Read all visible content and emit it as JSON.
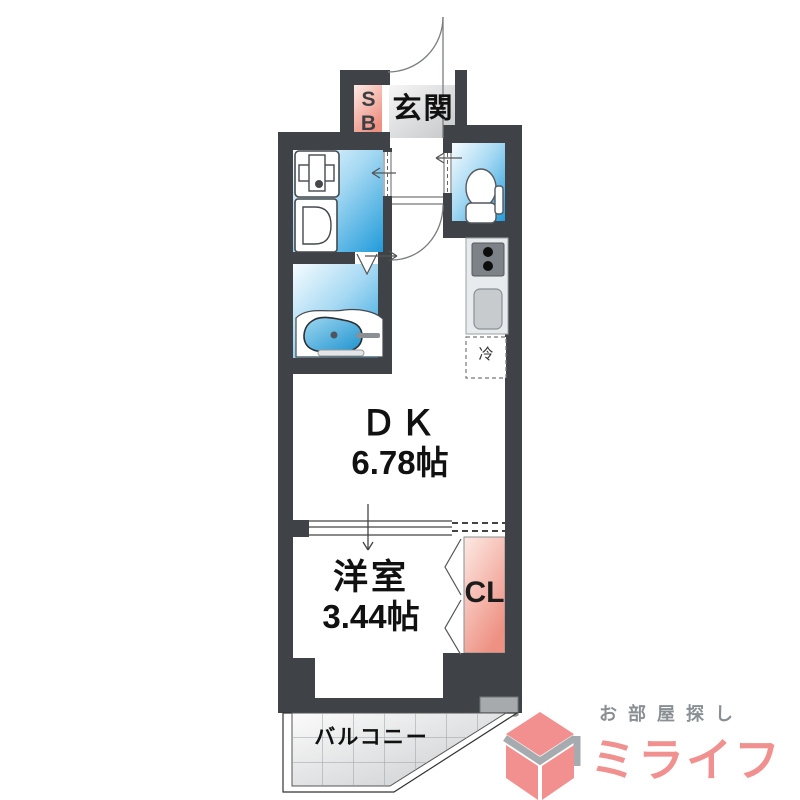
{
  "floor_plan": {
    "entrance": {
      "label": "玄関",
      "shoe_box": "SB"
    },
    "rooms": {
      "dk": {
        "name": "ＤＫ",
        "size": "6.78帖"
      },
      "western": {
        "name": "洋室",
        "size": "3.44帖"
      },
      "closet_label": "CL",
      "fridge_label": "冷",
      "balcony_label": "バルコニー"
    }
  },
  "logo": {
    "tagline": "お部屋探し",
    "name": "ミライフ"
  },
  "colors": {
    "wall": "#3f4347",
    "water_room_blue": "#219bda",
    "accent_pink": "#ee9183",
    "entrance_gray": "#c7c9cb",
    "brand_pink": "#f0908f",
    "tagline_gray": "#8a8f94"
  }
}
